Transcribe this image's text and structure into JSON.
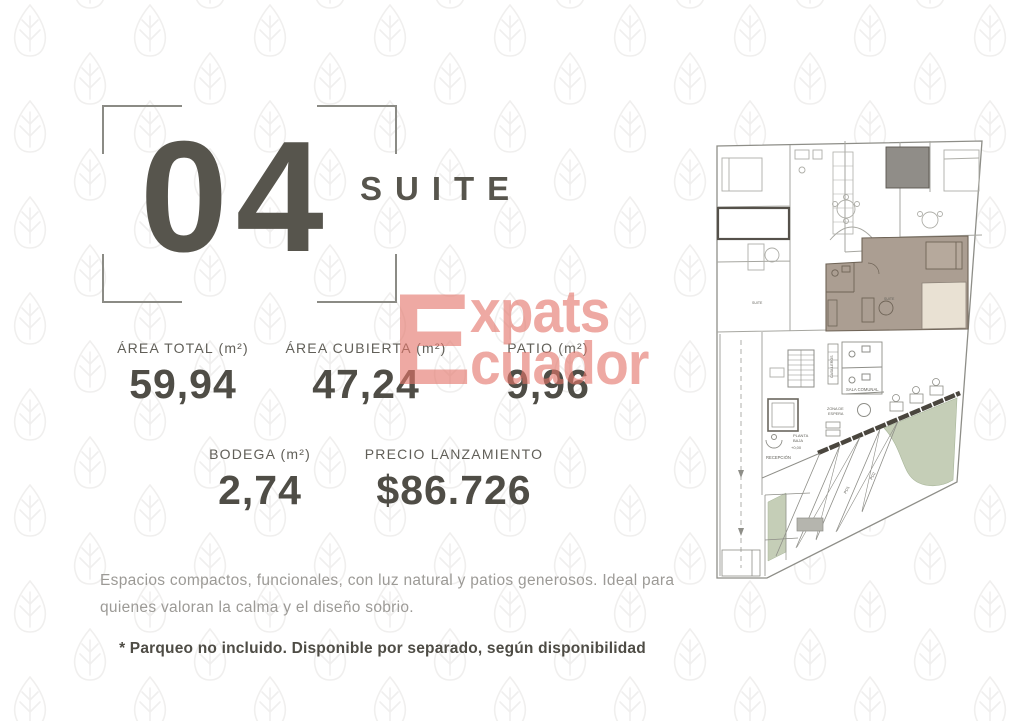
{
  "header": {
    "unit_number": "04",
    "unit_type": "SUITE"
  },
  "stats": [
    {
      "label": "ÁREA TOTAL (m²)",
      "value": "59,94"
    },
    {
      "label": "ÁREA CUBIERTA (m²)",
      "value": "47,24"
    },
    {
      "label": "PATIO (m²)",
      "value": "9,96"
    },
    {
      "label": "BODEGA (m²)",
      "value": "2,74"
    },
    {
      "label": "PRECIO LANZAMIENTO",
      "value": "$86.726"
    }
  ],
  "watermark": {
    "initial": "E",
    "top": "xpats",
    "bottom": "cuador"
  },
  "description": "Espacios compactos, funcionales, con luz natural y patios generosos. Ideal para quienes valoran la calma y el diseño sobrio.",
  "footnote": "* Parqueo no incluido. Disponible por separado, según disponibilidad",
  "floorplan": {
    "labels": {
      "planta": "PLANTA",
      "baja": "BAJA",
      "level": "+0,00",
      "recepcion": "RECEPCIÓN",
      "sala_comunal": "SALA COMUNAL",
      "zona_line1": "ZONA DE",
      "zona_line2": "ESPERA",
      "casilleros": "CASILLEROS",
      "pd1": "PD1",
      "pd2": "PD2",
      "suite_left": "SUITE",
      "suite_right": "SUITE"
    }
  },
  "colors": {
    "headline": "#57554d",
    "stat_label": "#615f58",
    "stat_value": "#4f4d46",
    "description_text": "#9c9a96",
    "footnote_text": "#4e4c45",
    "watermark": "#e4766b",
    "unit_highlight": "#ab9e92",
    "patio": "#e9e1d3",
    "green_area": "#c5ceb7"
  }
}
